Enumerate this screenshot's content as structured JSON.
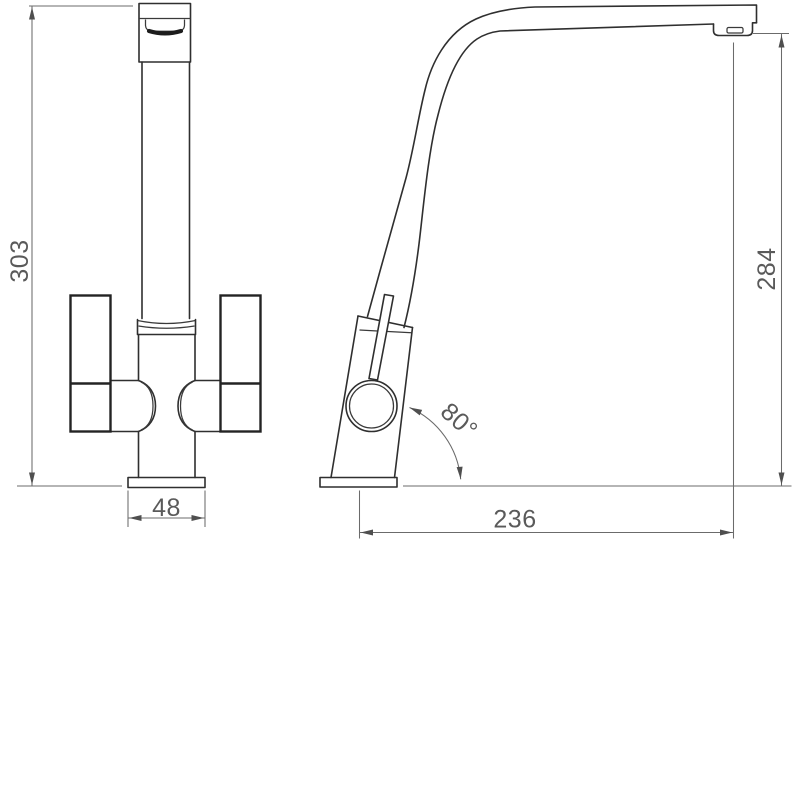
{
  "drawing": {
    "title": "Kitchen mixer tap dimensioned technical drawing, front and side elevations",
    "views": {
      "front": {
        "name": "front elevation",
        "dims": {
          "overall_height": {
            "label": "303",
            "orientation": "vertical"
          },
          "base_width": {
            "label": "48",
            "orientation": "horizontal"
          }
        }
      },
      "side": {
        "name": "side elevation",
        "dims": {
          "spout_height": {
            "label": "284",
            "orientation": "vertical"
          },
          "spout_reach": {
            "label": "236",
            "orientation": "horizontal"
          },
          "body_angle": {
            "label": "80°",
            "orientation": "angular"
          }
        }
      }
    },
    "colors": {
      "object_line": "#2f2f2f",
      "dimension_line": "#6b6b6b",
      "text": "#5a5a5a",
      "background": "#ffffff"
    }
  }
}
